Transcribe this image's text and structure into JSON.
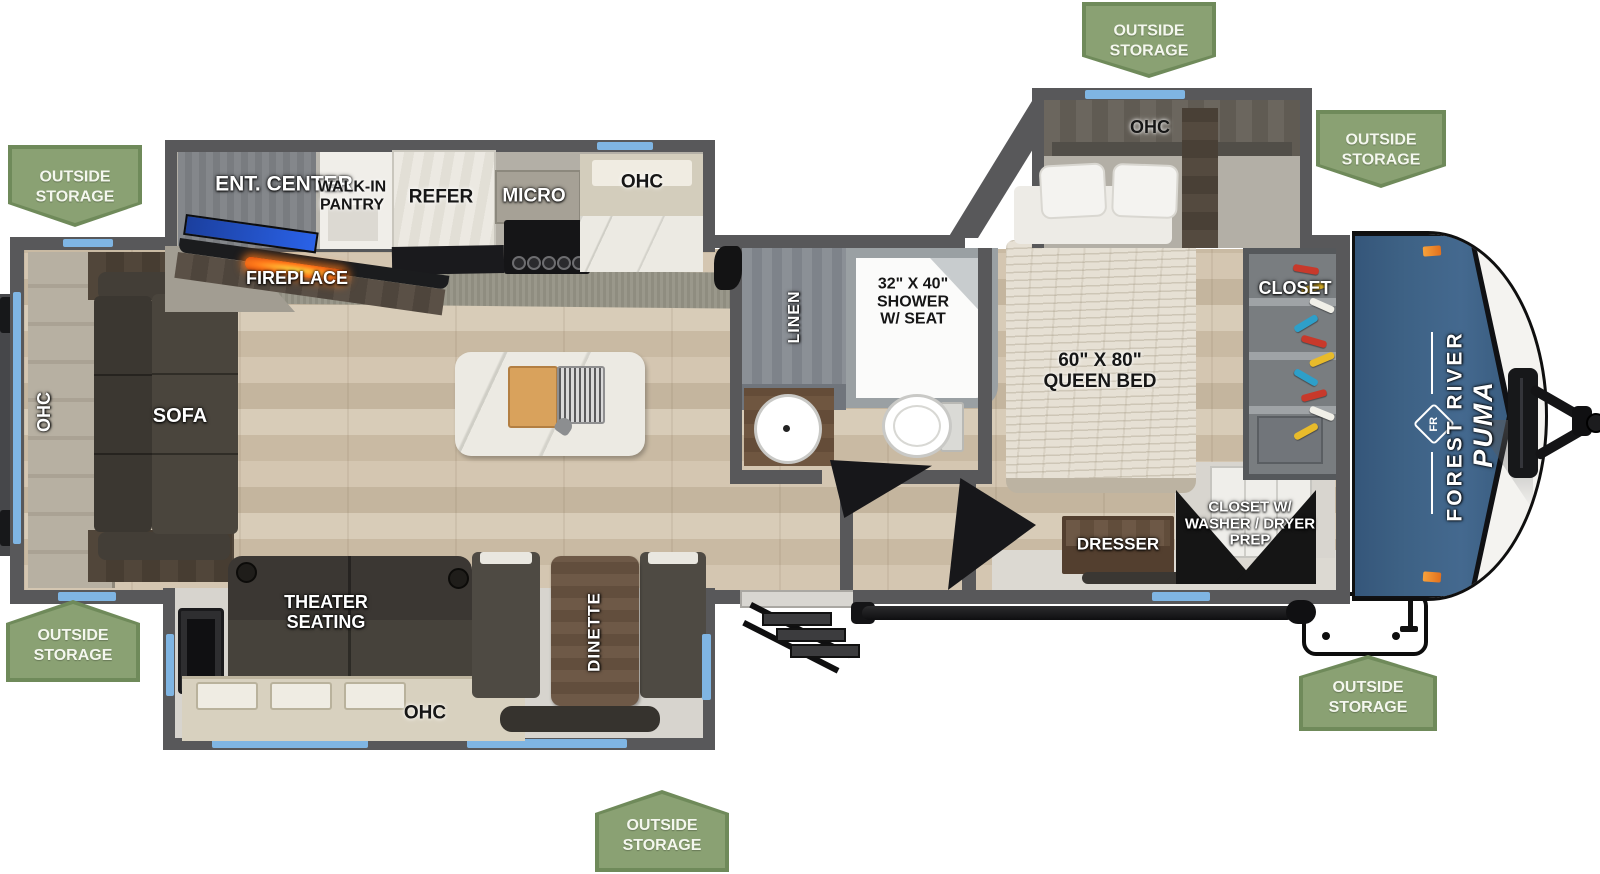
{
  "title": "Forest River Puma travel trailer floorplan",
  "front_cap": {
    "make": "FOREST RIVER",
    "model": "PUMA",
    "logo_text": "FR"
  },
  "outside_storage": {
    "lines": [
      "OUTSIDE",
      "STORAGE"
    ]
  },
  "labels": {
    "ent_center": "ENT. CENTER",
    "walk_in_pantry": [
      "WALK-IN",
      "PANTRY"
    ],
    "refer": "REFER",
    "micro": "MICRO",
    "ohc_kitchen": "OHC",
    "fireplace": "FIREPLACE",
    "ohc_rear": "OHC",
    "sofa": "SOFA",
    "theater_seating": [
      "THEATER",
      "SEATING"
    ],
    "ohc_theater": "OHC",
    "dinette": "DINETTE",
    "linen": "LINEN",
    "shower": [
      "32\" X 40\"",
      "SHOWER",
      "W/ SEAT"
    ],
    "queen_bed": [
      "60\" X 80\"",
      "QUEEN BED"
    ],
    "ohc_bedroom": "OHC",
    "closet": "CLOSET",
    "dresser": "DRESSER",
    "wd_closet": [
      "CLOSET W/",
      "WASHER / DRYER",
      "PREP"
    ]
  },
  "colors": {
    "badge_green": "#8aa173",
    "badge_border": "#6f8a5a",
    "wall_gray": "#58585a",
    "window_blue": "#7fb5e3",
    "brand_blue": "#3d6184",
    "marker_orange": "#ef9433",
    "flame_orange": "#ff7a1a"
  }
}
